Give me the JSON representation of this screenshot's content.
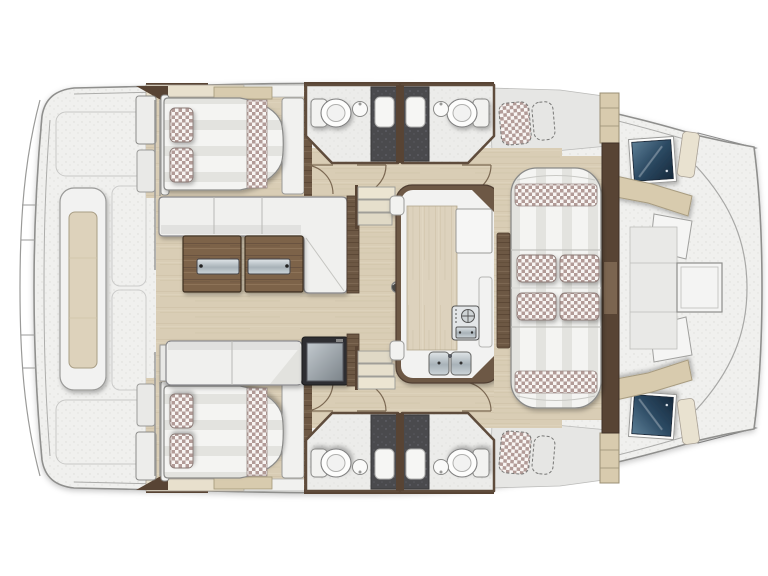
{
  "plan": {
    "subject": "catamaran-deck-floor-plan",
    "view": "top-down",
    "orientation": "bow-right-stern-left"
  },
  "palette": {
    "deck": "#f0f0ee",
    "deck_gray": "#e6e6e4",
    "wood": "#d9cdb5",
    "wood_line": "#c9bda2",
    "walnut": "#6d5844",
    "walnut_dark": "#584434",
    "cream": "#e8e0cd",
    "tan": "#d8cbae",
    "white_soft": "#f1f1ef",
    "bath": "#ececea",
    "shower": "#4a4a4d",
    "navy_deep": "#16293c",
    "checker": "#b29b97",
    "stripe": "#e3e3df",
    "table_wood": "#7d6349",
    "fridge": "#2e2e30",
    "metal_mid": "#a8b2b8",
    "outline": "#8a8a8a"
  },
  "inventory": {
    "cabins_with_double_bed": 2,
    "bed_pillows_per_cabin": 2,
    "bathrooms": 4,
    "toilets": 4,
    "bathroom_sinks": 4,
    "shower_stalls": 4,
    "sofas_in_saloon": 2,
    "coffee_table_sections": 2,
    "fridge_units": 1,
    "galley_islands": 1,
    "galley_sink_basins": 2,
    "stove_units": 1,
    "companionway_stairs": 2,
    "lounge_pads": 1,
    "lounge_scatter_cushions": 4,
    "lounge_checker_bolsters": 2,
    "deck_chaises_dashed": 2,
    "bow_hatches_navy": 2,
    "aft_bench_seats": 1,
    "bow_bench_backrests": 2
  }
}
